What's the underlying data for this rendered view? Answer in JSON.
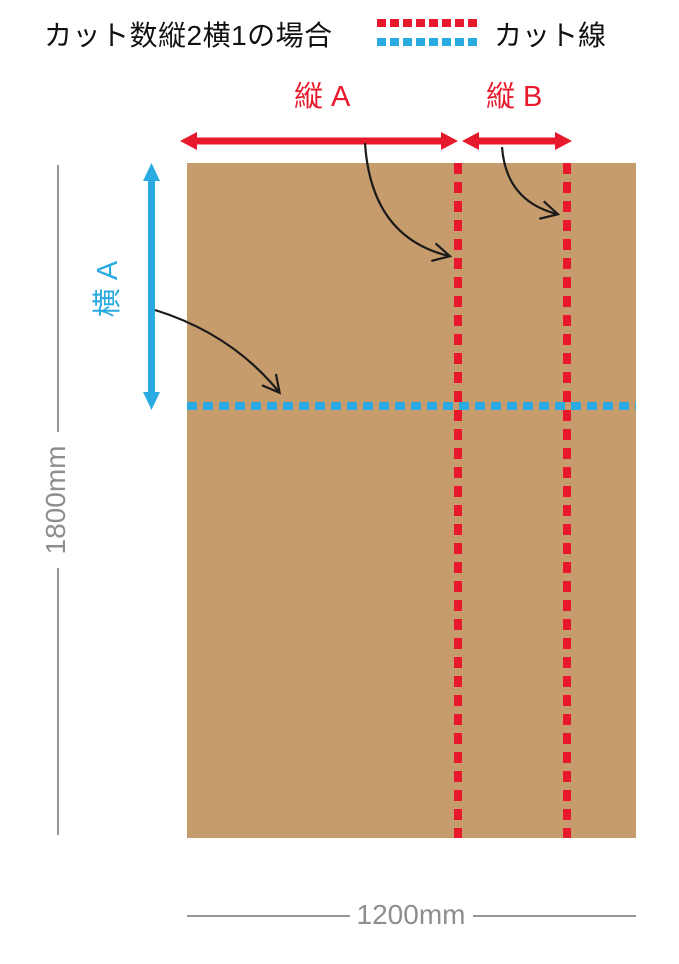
{
  "header": {
    "title": "カット数縦2横1の場合",
    "legend": {
      "label": "カット線"
    }
  },
  "labels": {
    "vertical_a": "縦 A",
    "vertical_b": "縦 B",
    "horizontal_a": "横 A"
  },
  "dimensions": {
    "board_height": "1800mm",
    "board_width": "1200mm"
  },
  "figure": {
    "type": "cutting-diagram",
    "cut_count_vertical": 2,
    "cut_count_horizontal": 1,
    "vertical_cut_lines": 2,
    "horizontal_cut_lines": 1
  },
  "colors": {
    "cut_line_red": "#e8192c",
    "cut_line_blue": "#29abe2",
    "board_brown": "#c69c6d",
    "dimension_gray": "#8e8e8e",
    "text_black": "#111111"
  }
}
